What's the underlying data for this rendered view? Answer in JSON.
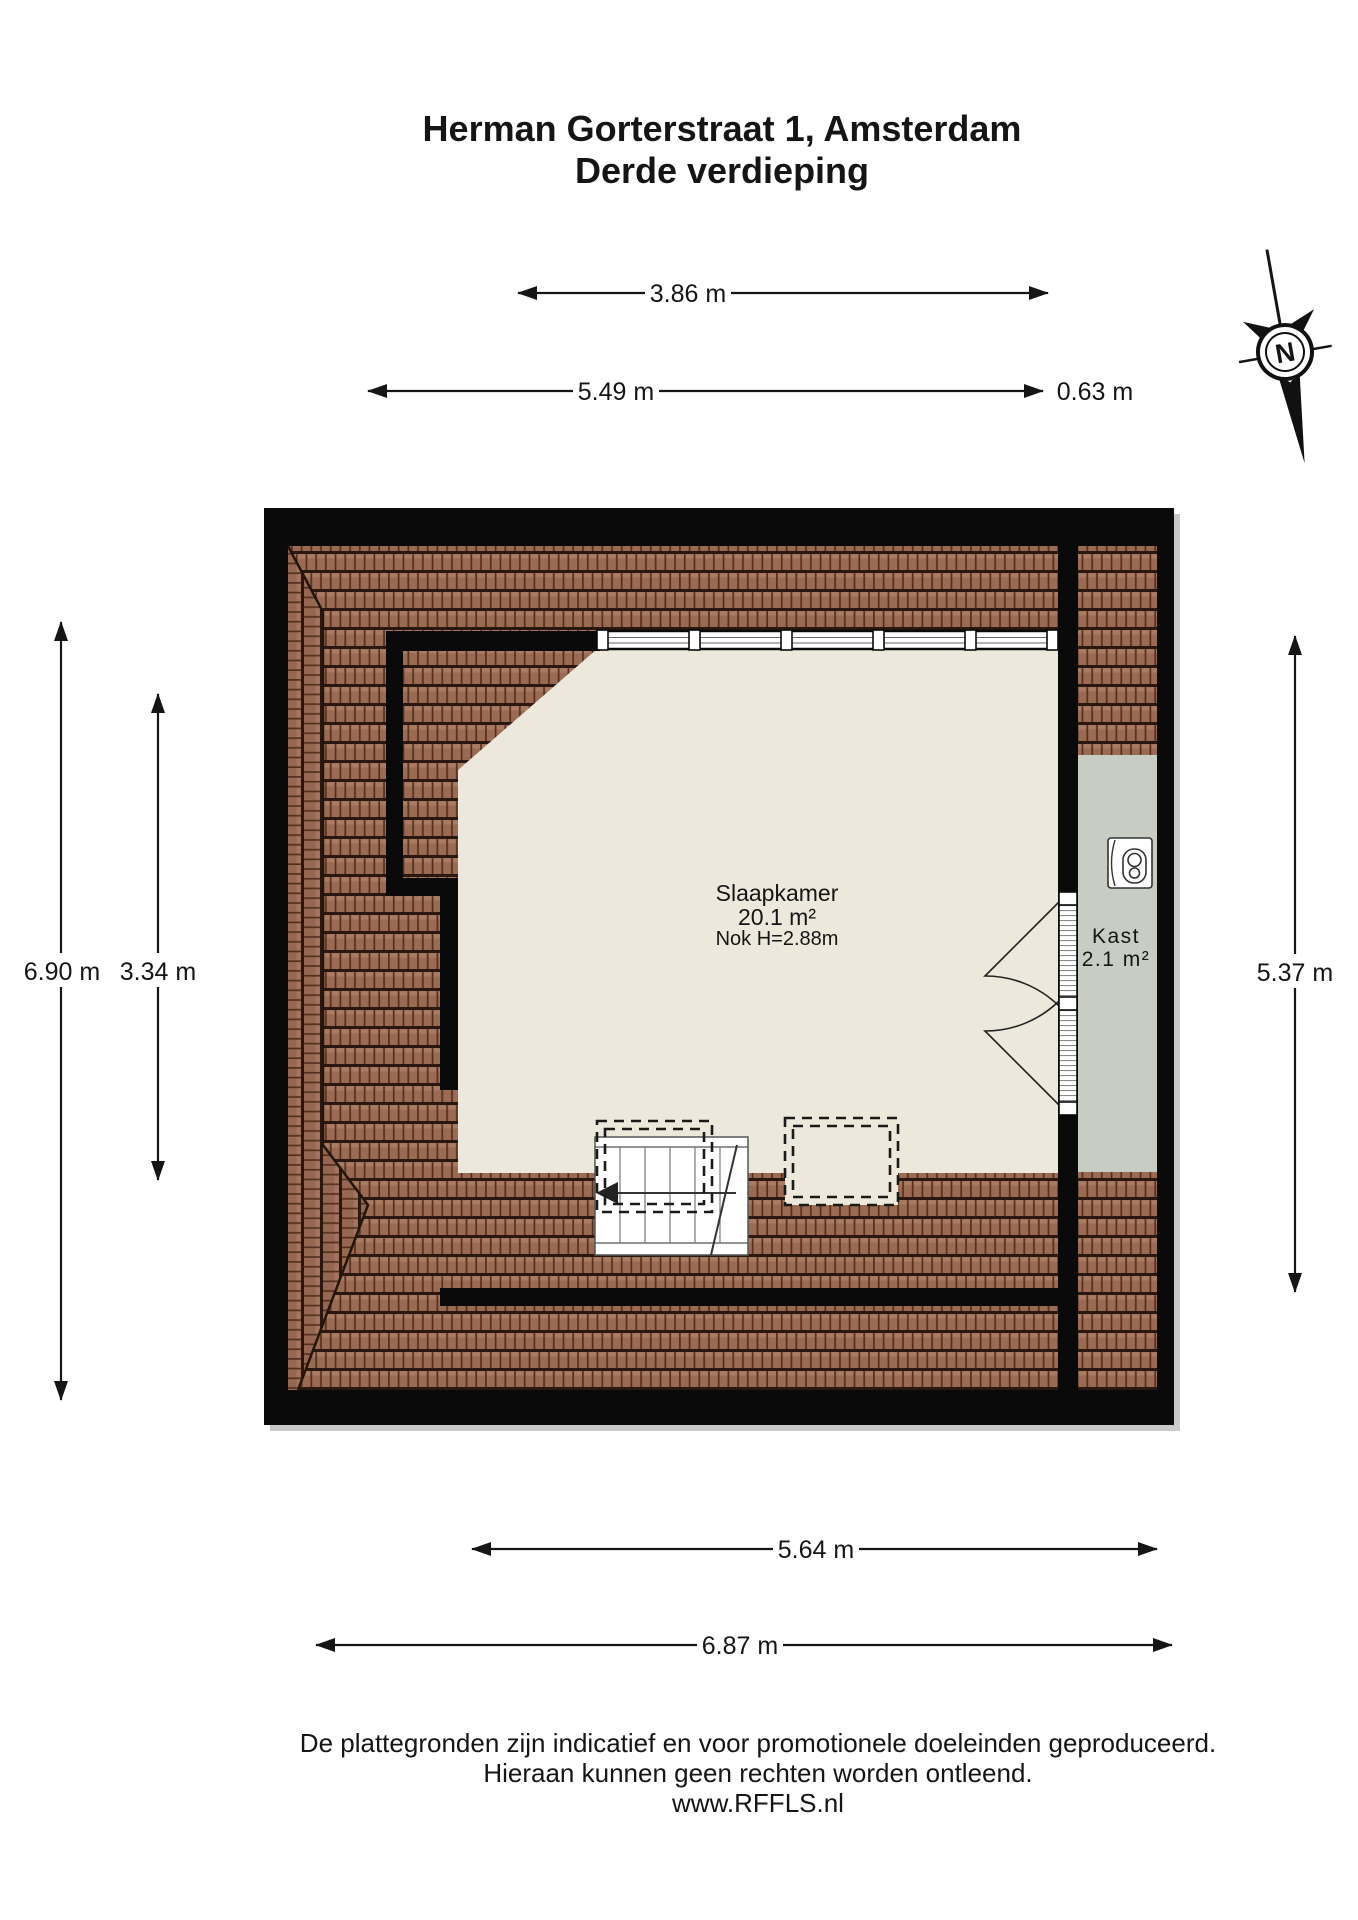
{
  "title": {
    "line1": "Herman Gorterstraat 1, Amsterdam",
    "line2": "Derde verdieping"
  },
  "compass": {
    "north_label": "N"
  },
  "dimensions": {
    "top_inner": {
      "label": "3.86 m"
    },
    "top_outer": {
      "label": "5.49 m"
    },
    "top_right": {
      "label": "0.63 m"
    },
    "left_outer": {
      "label": "6.90 m"
    },
    "left_inner": {
      "label": "3.34 m"
    },
    "right": {
      "label": "5.37 m"
    },
    "bottom_inner": {
      "label": "5.64 m"
    },
    "bottom_outer": {
      "label": "6.87 m"
    }
  },
  "rooms": {
    "slaapkamer": {
      "name": "Slaapkamer",
      "area": "20.1 m²",
      "note": "Nok H=2.88m"
    },
    "kast": {
      "name": "Kast",
      "area": "2.1 m²"
    }
  },
  "footer": {
    "line1": "De plattegronden zijn indicatief en voor promotionele doeleinden geproduceerd.",
    "line2": "Hieraan kunnen geen rechten worden ontleend.",
    "line3": "www.RFFLS.nl"
  },
  "colors": {
    "roof_tile": "#9a6a52",
    "roof_dark": "#2a1810",
    "floor": "#ece8db",
    "closet_floor": "#c8cdc3",
    "wall": "#0a0a0a"
  }
}
